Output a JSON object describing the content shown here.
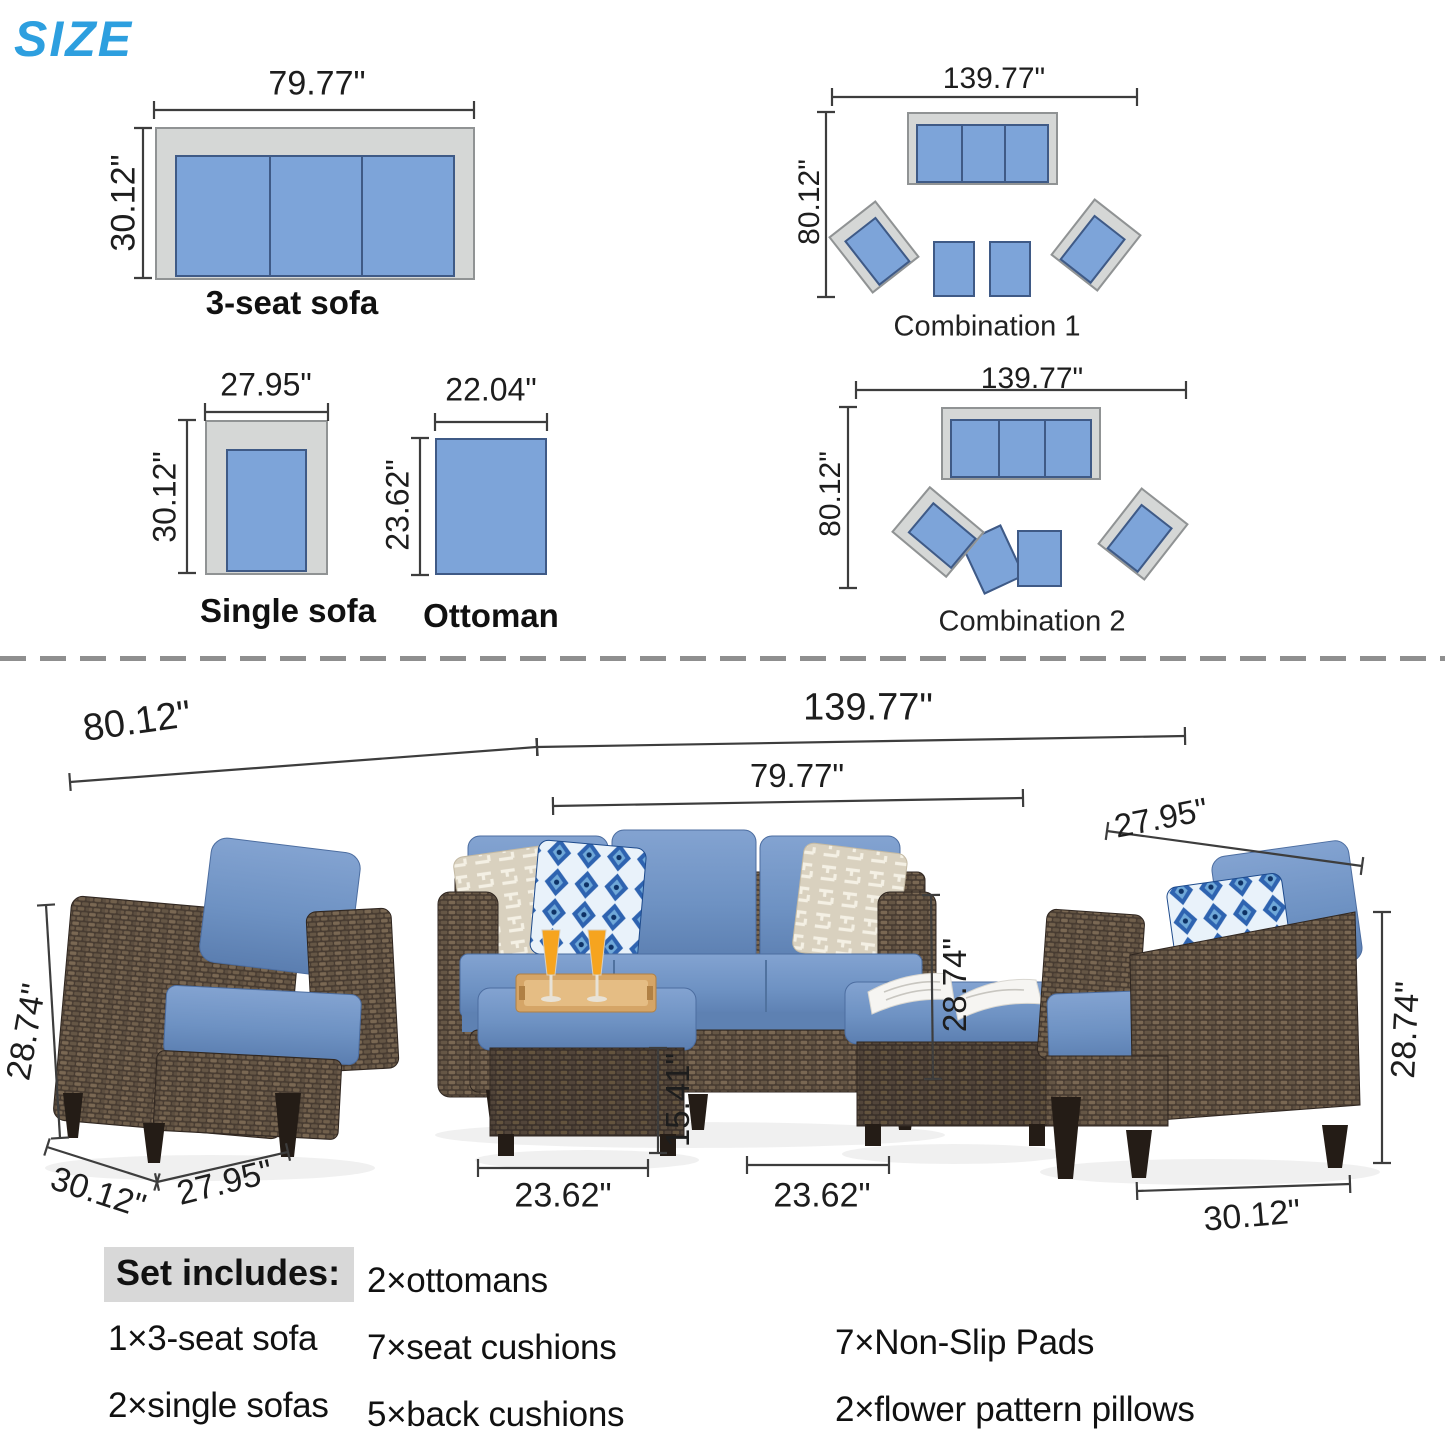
{
  "title": "SIZE",
  "diagrams": {
    "sofa3": {
      "label": "3-seat sofa",
      "width": "79.77\"",
      "depth": "30.12\""
    },
    "single": {
      "label": "Single sofa",
      "width": "27.95\"",
      "depth": "30.12\""
    },
    "ottoman": {
      "label": "Ottoman",
      "width": "22.04\"",
      "depth": "23.62\""
    },
    "combo1": {
      "label": "Combination 1",
      "width": "139.77\"",
      "depth": "80.12\""
    },
    "combo2": {
      "label": "Combination 2",
      "width": "139.77\"",
      "depth": "80.12\""
    }
  },
  "photo": {
    "span_left": "80.12\"",
    "span_total": "139.77\"",
    "sofa_width": "79.77\"",
    "chair_width": "27.95\"",
    "chair_height_left": "28.74\"",
    "sofa_height": "28.74\"",
    "chair_height_right": "28.74\"",
    "ottoman_height": "15.41\"",
    "chair_depth_left": "30.12\"",
    "chair_front_left": "27.95\"",
    "ottoman_width_left": "23.62\"",
    "ottoman_width_right": "23.62\"",
    "chair_depth_right": "30.12\""
  },
  "set_includes": {
    "heading": "Set includes:",
    "col1": [
      "1×3-seat sofa",
      "2×single sofas"
    ],
    "col2": [
      "2×ottomans",
      "7×seat cushions",
      "5×back cushions"
    ],
    "col3": [
      "7×Non-Slip Pads",
      "2×flower pattern pillows"
    ]
  },
  "colors": {
    "accent_blue": "#2d9fdf",
    "diagram_cushion": "#7da4d9",
    "diagram_frame": "#d5d7d6",
    "photo_cushion": "#6e92c3",
    "wicker_brown": "#54463b"
  }
}
